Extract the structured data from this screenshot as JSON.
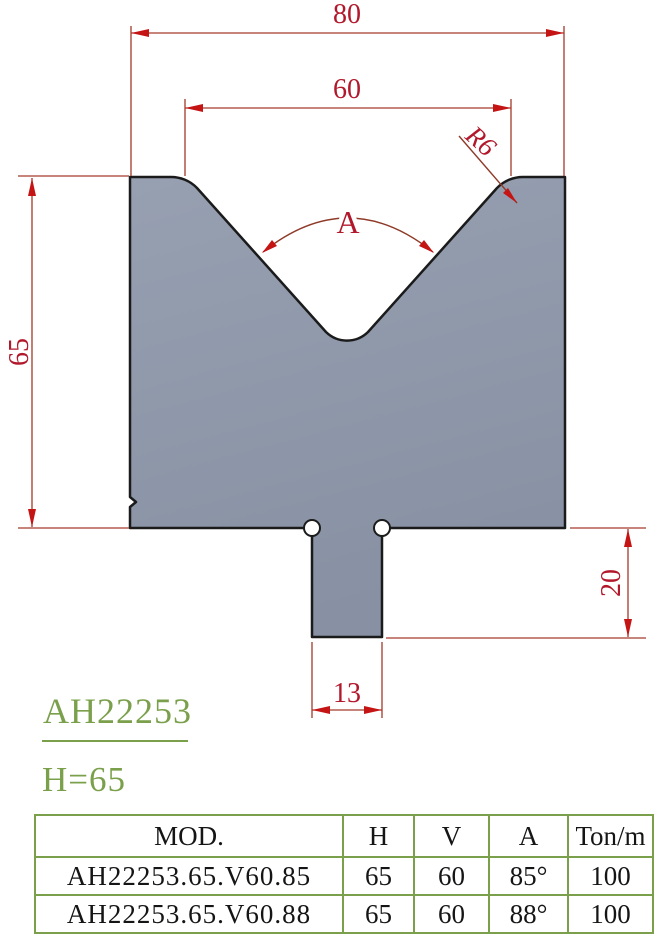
{
  "figure": {
    "code": "AH22253",
    "height_label": "H=65"
  },
  "drawing": {
    "dim_top_width": "80",
    "dim_v_opening": "60",
    "dim_body_height": "65",
    "dim_shank_height": "20",
    "dim_shank_width": "13",
    "angle_label": "A",
    "radius_label": "R6"
  },
  "table": {
    "headers": [
      "MOD.",
      "H",
      "V",
      "A",
      "Ton/m"
    ],
    "rows": [
      [
        "AH22253.65.V60.85",
        "65",
        "60",
        "85°",
        "100"
      ],
      [
        "AH22253.65.V60.88",
        "65",
        "60",
        "88°",
        "100"
      ]
    ]
  },
  "colors": {
    "die_fill": "#8d95a7",
    "outline": "#1b1b1b",
    "dim_line": "#a33a2a",
    "arrow_red": "#c41414",
    "dim_text_red": "#b2182b",
    "accent_green": "#7ba04c"
  }
}
